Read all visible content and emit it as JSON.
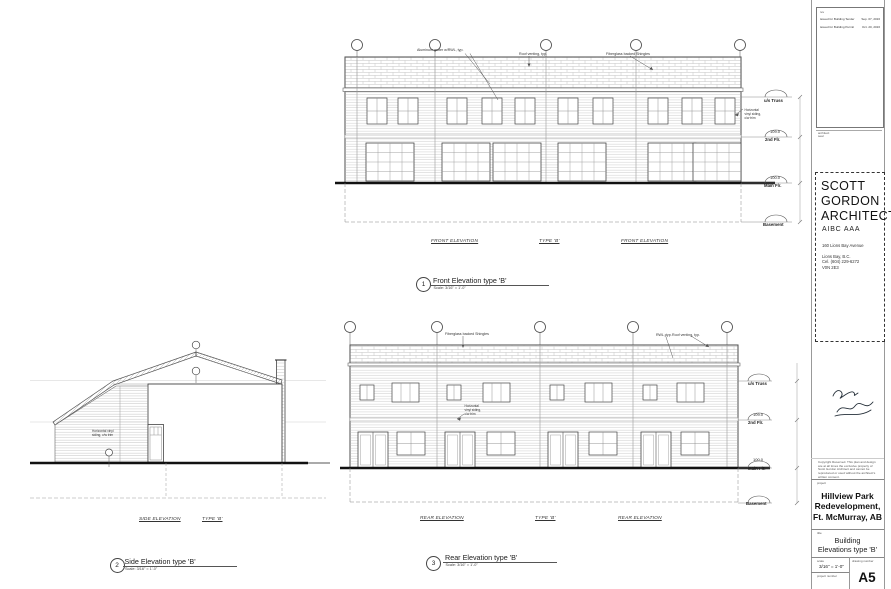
{
  "views": {
    "front": {
      "num": "1",
      "title": "Front Elevation type 'B'",
      "scale_note": "Scale: 3/16\" = 1'-0\"",
      "caption_left": "FRONT ELEVATION",
      "caption_mid": "TYPE 'B'",
      "caption_right": "FRONT ELEVATION",
      "ann_gutter": "Aluminum gutter w/RWL, typ.",
      "ann_vent": "Roof venting, typ.",
      "ann_shingles": "Fiberglass backed Shingles",
      "ann_siding": "Horizontal vinyl siding, c/w trim"
    },
    "side": {
      "num": "2",
      "title": "Side Elevation type 'B'",
      "scale_note": "Scale: 3/16\" = 1'-0\"",
      "caption_left": "SIDE ELEVATION",
      "caption_mid": "TYPE 'B'",
      "ann_siding": "Horizontal vinyl siding, c/w trim"
    },
    "rear": {
      "num": "3",
      "title": "Rear Elevation type 'B'",
      "scale_note": "Scale: 3/16\" = 1'-0\"",
      "caption_left": "REAR ELEVATION",
      "caption_mid": "TYPE 'B'",
      "caption_right": "REAR ELEVATION",
      "ann_shingles": "Fiberglass backed Shingles",
      "ann_rwl": "RWL, typ.",
      "ann_vent": "Roof venting, typ.",
      "ann_siding": "Horizontal vinyl siding, c/w trim"
    }
  },
  "levels": {
    "truss": "u/s Truss",
    "second_val": "109.0",
    "second": "2nd Flr.",
    "main_val": "100.0",
    "main": "Main Flr.",
    "basement": "Basement"
  },
  "titleblock": {
    "revisions": {
      "header": "rev",
      "row1_label": "issued for Building Tender",
      "row1_date": "Sep. 07, 2016",
      "row2_label": "issued for Building Permit",
      "row2_date": "Oct. 20, 2016",
      "seal_note": "architect seal"
    },
    "architect": {
      "name1": "SCOTT",
      "name2": "GORDON",
      "name3": "ARCHITECT",
      "assoc": "AIBC  AAA",
      "addr1": "160 Lions Bay Avenue",
      "addr2": "Lions Bay, B.C.",
      "addr3": "V0N 2E3",
      "phone": "Cel. (604) 229-6272"
    },
    "copyright": "Copyright Reserved. This plan and design are at all times the exclusive property of Scott Gordon Architect and cannot be reproduced or used without the architect's written consent.",
    "project_label": "project",
    "project_name1": "Hillview Park",
    "project_name2": "Redevelopment,",
    "project_name3": "Ft. McMurray, AB",
    "title_label": "title",
    "sheet_title1": "Building",
    "sheet_title2": "Elevations type 'B'",
    "scale_label": "scale",
    "scale_value": "3/16\" = 1'-0\"",
    "drawing_number_label": "drawing number",
    "project_number_label": "project number",
    "sheet_number": "A5"
  }
}
